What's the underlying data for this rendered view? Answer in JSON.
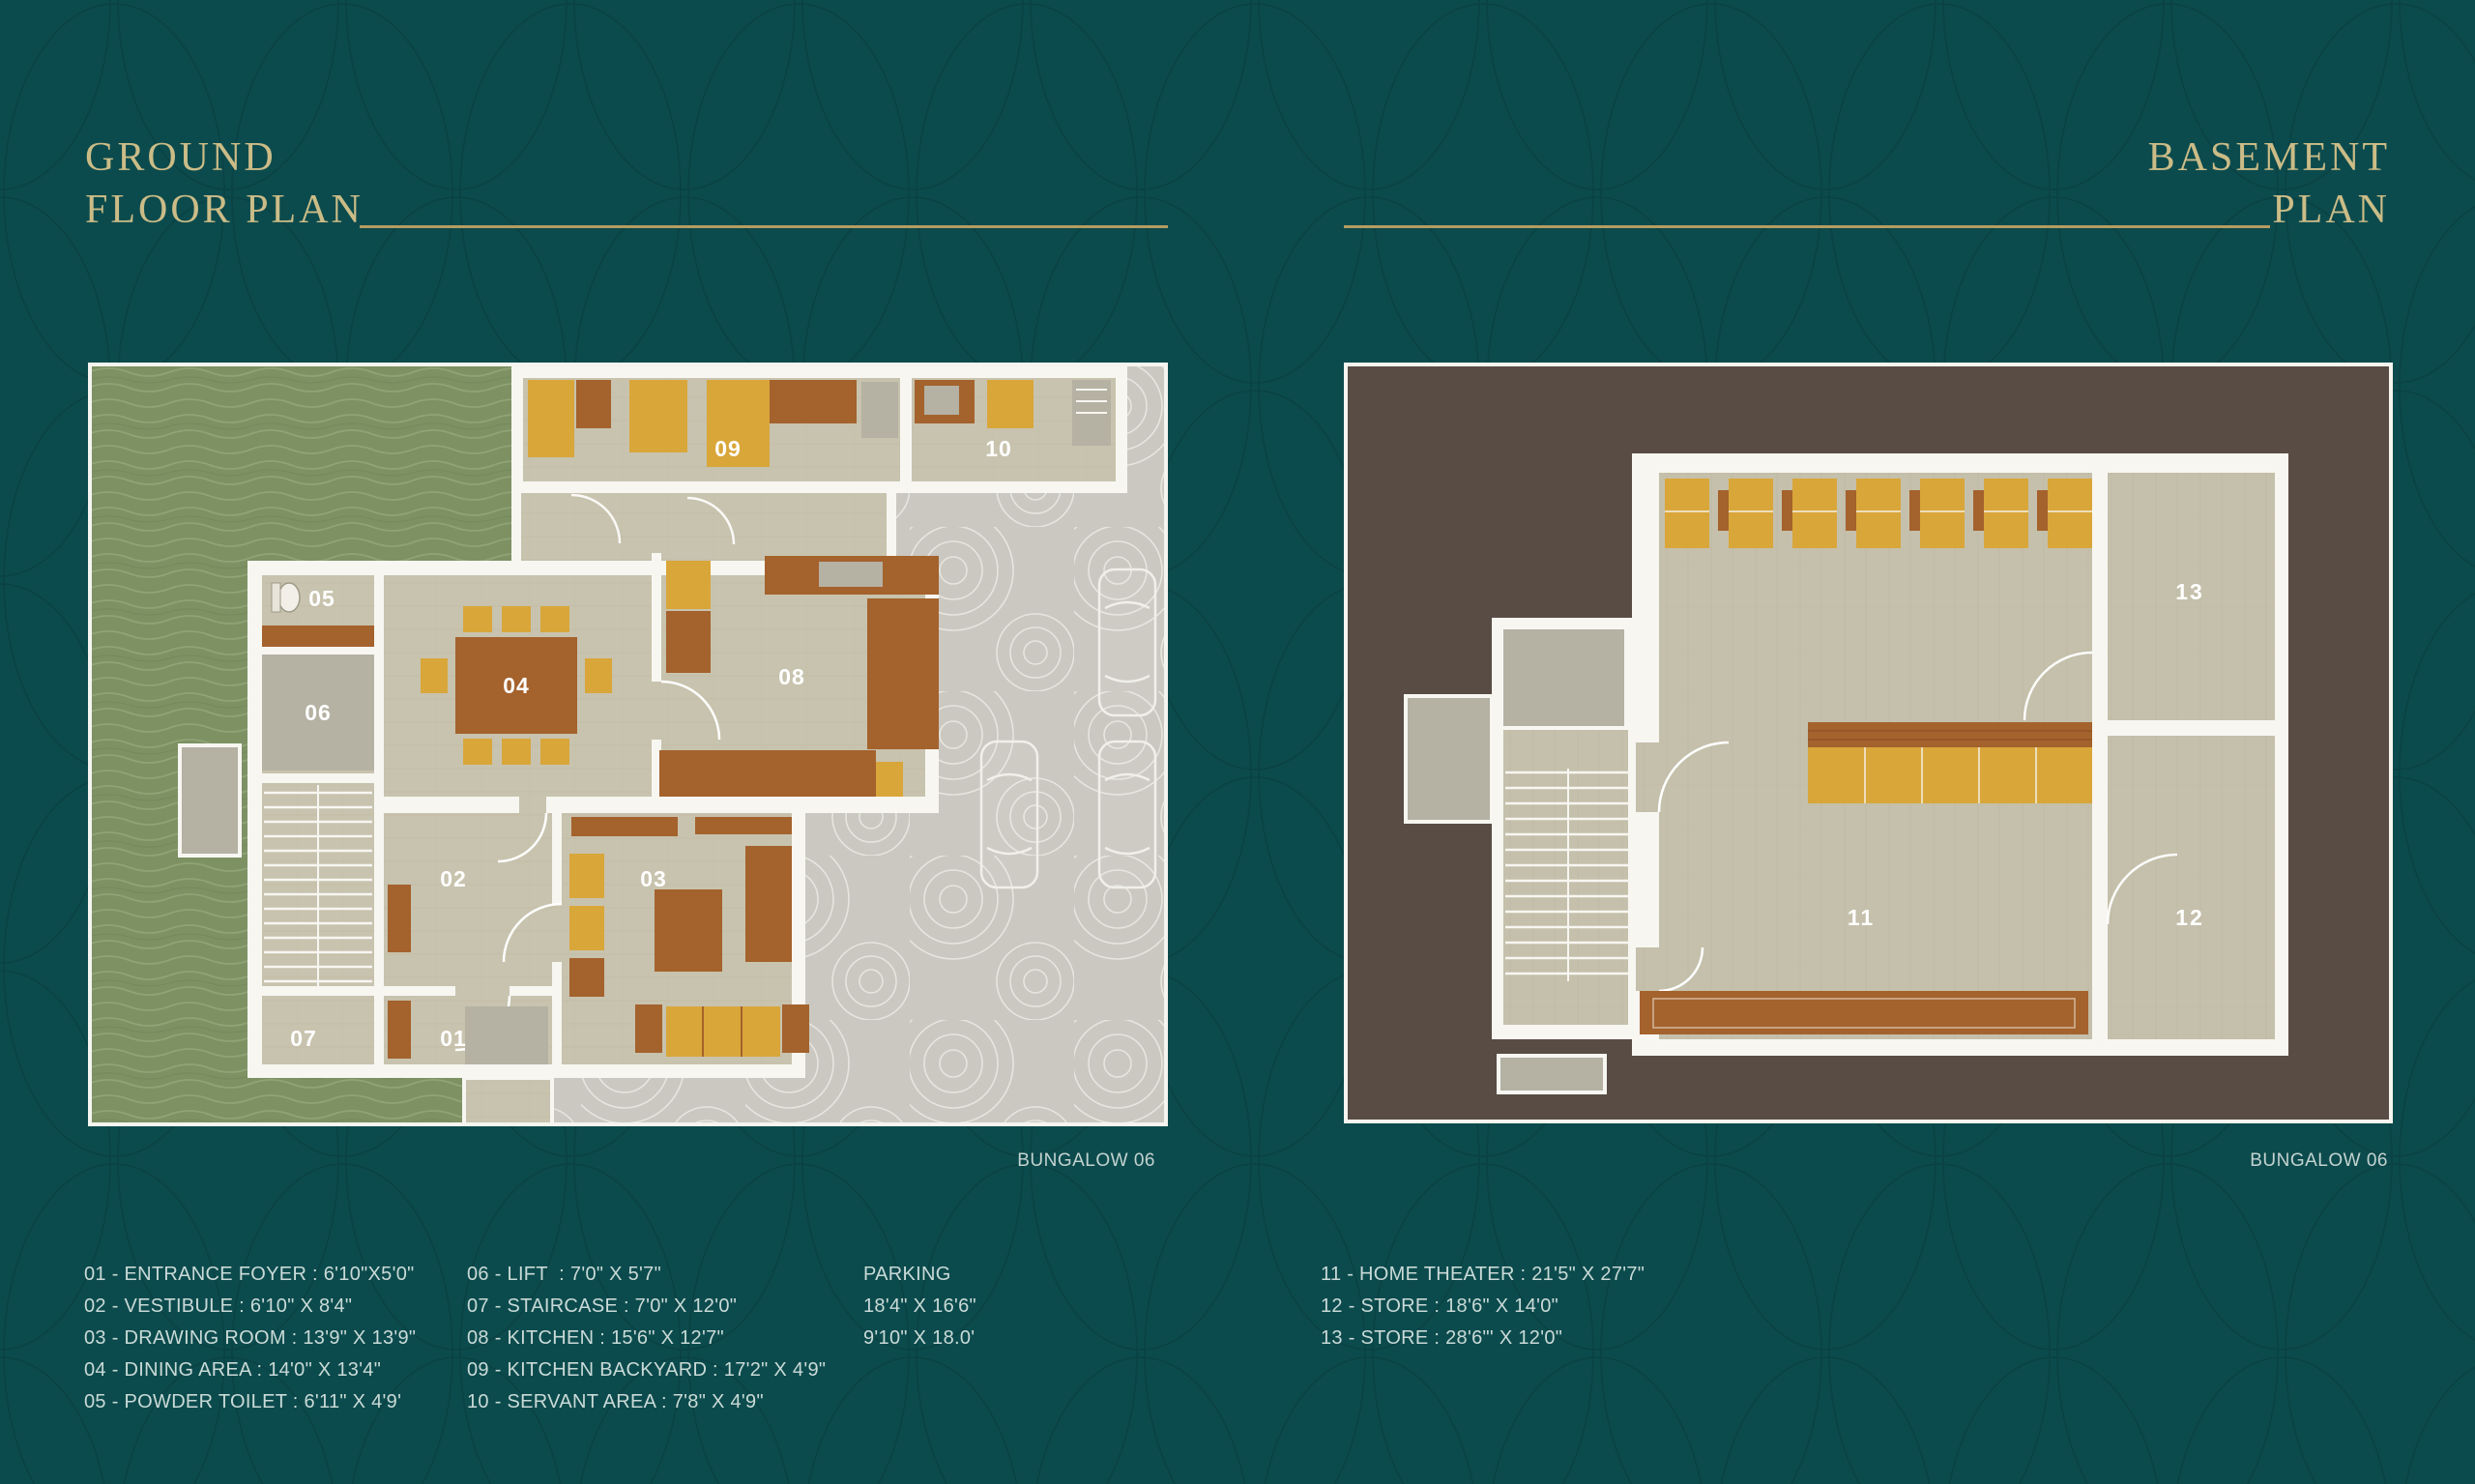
{
  "header": {
    "left_title": [
      "GROUND",
      "FLOOR PLAN"
    ],
    "right_title": [
      "BASEMENT",
      "PLAN"
    ]
  },
  "captions": {
    "left": "BUNGALOW 06",
    "right": "BUNGALOW 06"
  },
  "plans": {
    "ground": {
      "labels": {
        "n01": "01",
        "n02": "02",
        "n03": "03",
        "n04": "04",
        "n05": "05",
        "n06": "06",
        "n07": "07",
        "n08": "08",
        "n09": "09",
        "n10": "10"
      }
    },
    "basement": {
      "labels": {
        "n11": "11",
        "n12": "12",
        "n13": "13"
      }
    }
  },
  "legend": {
    "col1": [
      "01 - ENTRANCE FOYER : 6'10\"X5'0\"",
      "02 - VESTIBULE : 6'10\" X 8'4\"",
      "03 - DRAWING ROOM : 13'9\" X 13'9\"",
      "04 - DINING AREA : 14'0\" X 13'4\"",
      "05 - POWDER TOILET : 6'11\" X 4'9'"
    ],
    "col2": [
      "06 - LIFT  : 7'0\" X 5'7\"",
      "07 - STAIRCASE : 7'0\" X 12'0\"",
      "08 - KITCHEN : 15'6\" X 12'7\"",
      "09 - KITCHEN BACKYARD : 17'2\" X 4'9\"",
      "10 - SERVANT AREA : 7'8\" X 4'9\""
    ],
    "col3": [
      "PARKING",
      "18'4\" X 16'6\"",
      "9'10\" X 18.0'"
    ],
    "col4": [
      "11 - HOME THEATER : 21'5\" X 27'7\"",
      "12 - STORE : 18'6\" X 14'0\"",
      "13 - STORE : 28'6\"' X 12'0\""
    ]
  },
  "colors": {
    "background_teal": "#0c4b4d",
    "pattern_line": "#083d3f",
    "title_gold": "#cbbc87",
    "rule_gold": "#b59c61",
    "legend_text": "#c9dad7",
    "grass_green": "#7d9163",
    "paving_gray": "#cac8c0",
    "floor_beige": "#c8c3ae",
    "wall_white": "#f7f6f1",
    "furniture_brown": "#a4622d",
    "furniture_yellow": "#d9a63a",
    "fixture_gray": "#b5b1a3",
    "basement_brown": "#584c44"
  }
}
